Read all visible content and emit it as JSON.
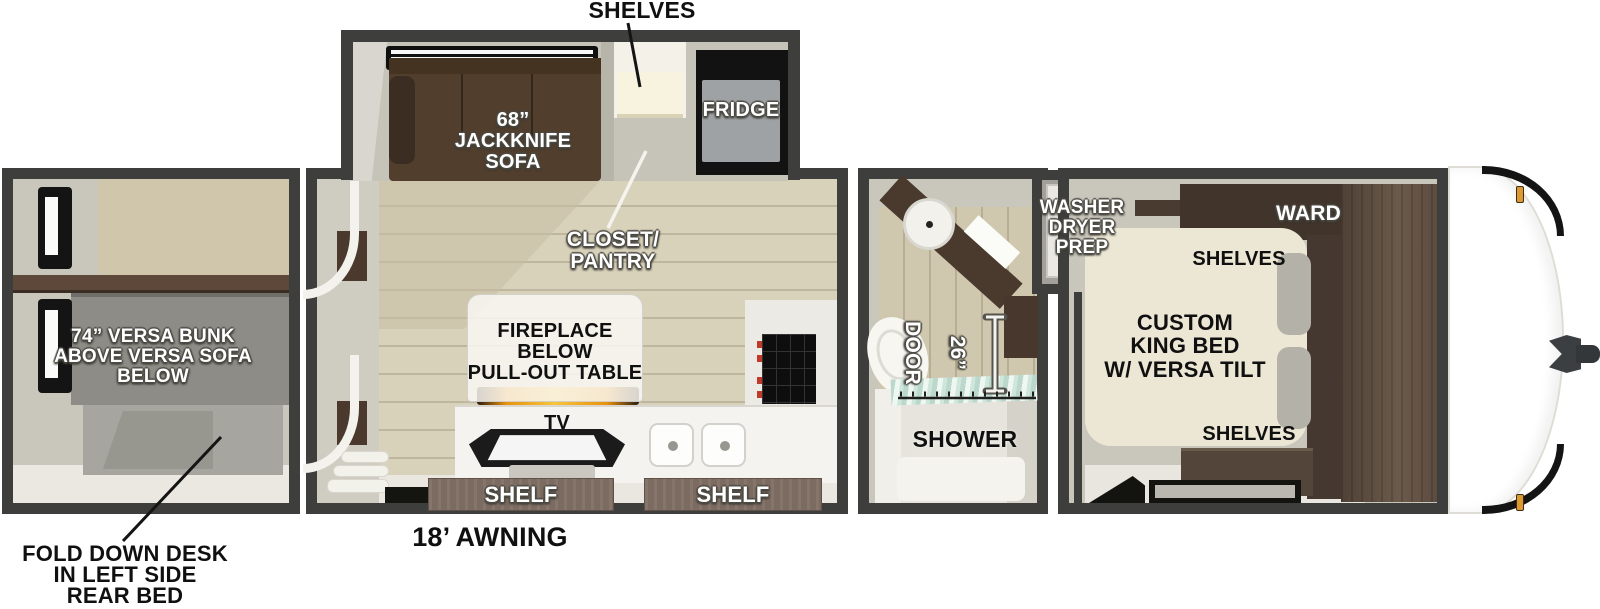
{
  "colors": {
    "wall": "#3e3f3d",
    "interior_greige": "#c9c6bc",
    "wood_floor": "#d9d2bb",
    "sofa_brown": "#523e2d",
    "cabinet_brown": "#463a2f",
    "ward_brown": "#41342b",
    "bed_cream": "#ece7d5",
    "bunk_gray": "#8d8c86",
    "fridge_gray": "#9fa2a4",
    "shelf_bar_brown": "#7c6b60",
    "flame_orange": "#ef9b1a",
    "marker_light_amber": "#dd9a33",
    "shower_glass_teal": "#bcd8cc"
  },
  "callouts": {
    "shelves_top": "SHELVES",
    "fold_down_desk": "FOLD DOWN DESK\nIN LEFT SIDE\nREAR BED",
    "awning": "18’ AWNING"
  },
  "rear_bedroom": {
    "bunk_label": "74” VERSA BUNK\nABOVE VERSA SOFA\nBELOW"
  },
  "living_kitchen": {
    "sofa_label": "68”\nJACKKNIFE\nSOFA",
    "closet_label": "CLOSET/\nPANTRY",
    "fridge_label": "FRIDGE",
    "fireplace_label": "FIREPLACE\nBELOW\nPULL-OUT TABLE",
    "tv_label": "TV",
    "shelf_left_label": "SHELF",
    "shelf_right_label": "SHELF"
  },
  "bathroom": {
    "door_width_label": "26”",
    "door_label": "DOOR",
    "shower_label": "SHOWER"
  },
  "utility": {
    "washer_dryer_label": "WASHER\nDRYER\nPREP"
  },
  "front_bedroom": {
    "ward_label": "WARD",
    "shelves_upper_label": "SHELVES",
    "bed_label": "CUSTOM\nKING BED\nW/ VERSA TILT",
    "shelves_lower_label": "SHELVES"
  }
}
